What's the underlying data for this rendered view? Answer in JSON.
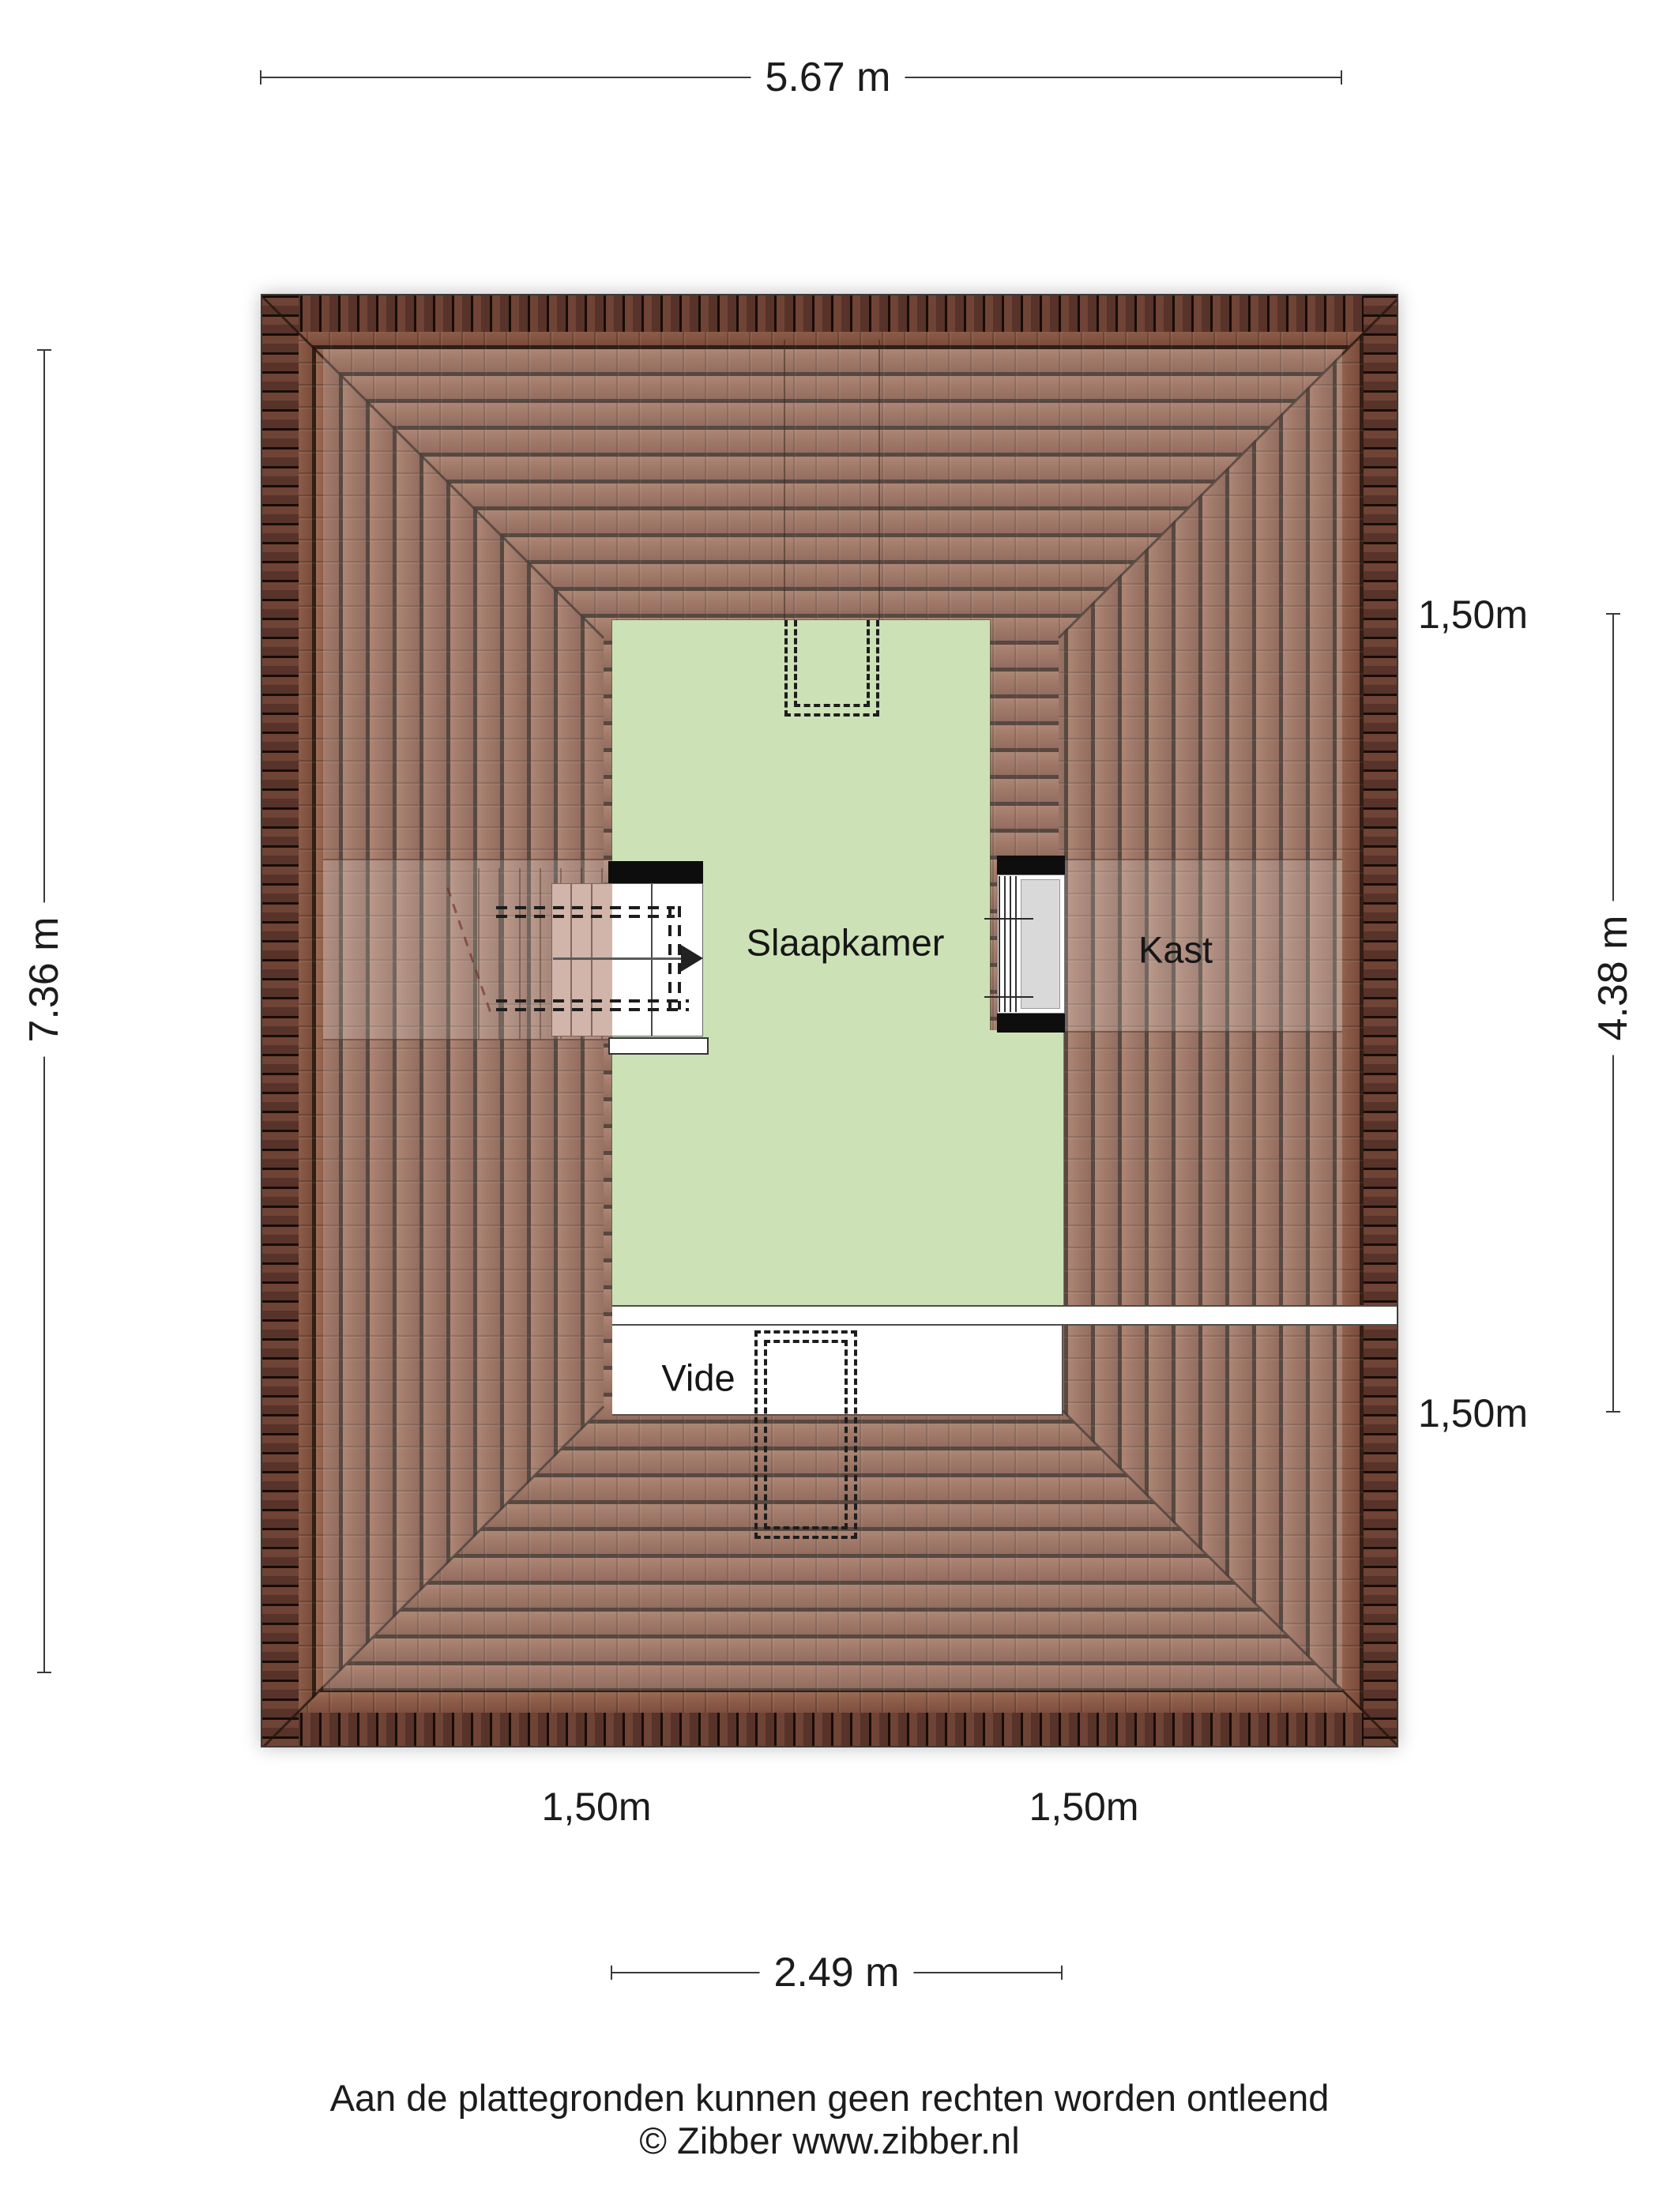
{
  "plan": {
    "rooms": {
      "slaapkamer": "Slaapkamer",
      "kast": "Kast",
      "vide": "Vide"
    },
    "dimensions": {
      "top": "5.67 m",
      "left": "7.36 m",
      "right": "4.38 m",
      "bottom": "2.49 m",
      "clearance_right_top": "1,50m",
      "clearance_right_bottom": "1,50m",
      "clearance_bottom_left": "1,50m",
      "clearance_bottom_right": "1,50m"
    },
    "colors": {
      "roof_tile": "#8b5b47",
      "roof_tile_dark": "#311e14",
      "roof_ridge": "#57332a",
      "room_fill": "#cde1b6",
      "window_panel": "#d9d9d9",
      "dimension_line": "#3a3a3a",
      "text": "#1c1c1c"
    }
  },
  "footer": {
    "disclaimer": "Aan de plattegronden kunnen geen rechten worden ontleend",
    "credit": "© Zibber www.zibber.nl"
  }
}
